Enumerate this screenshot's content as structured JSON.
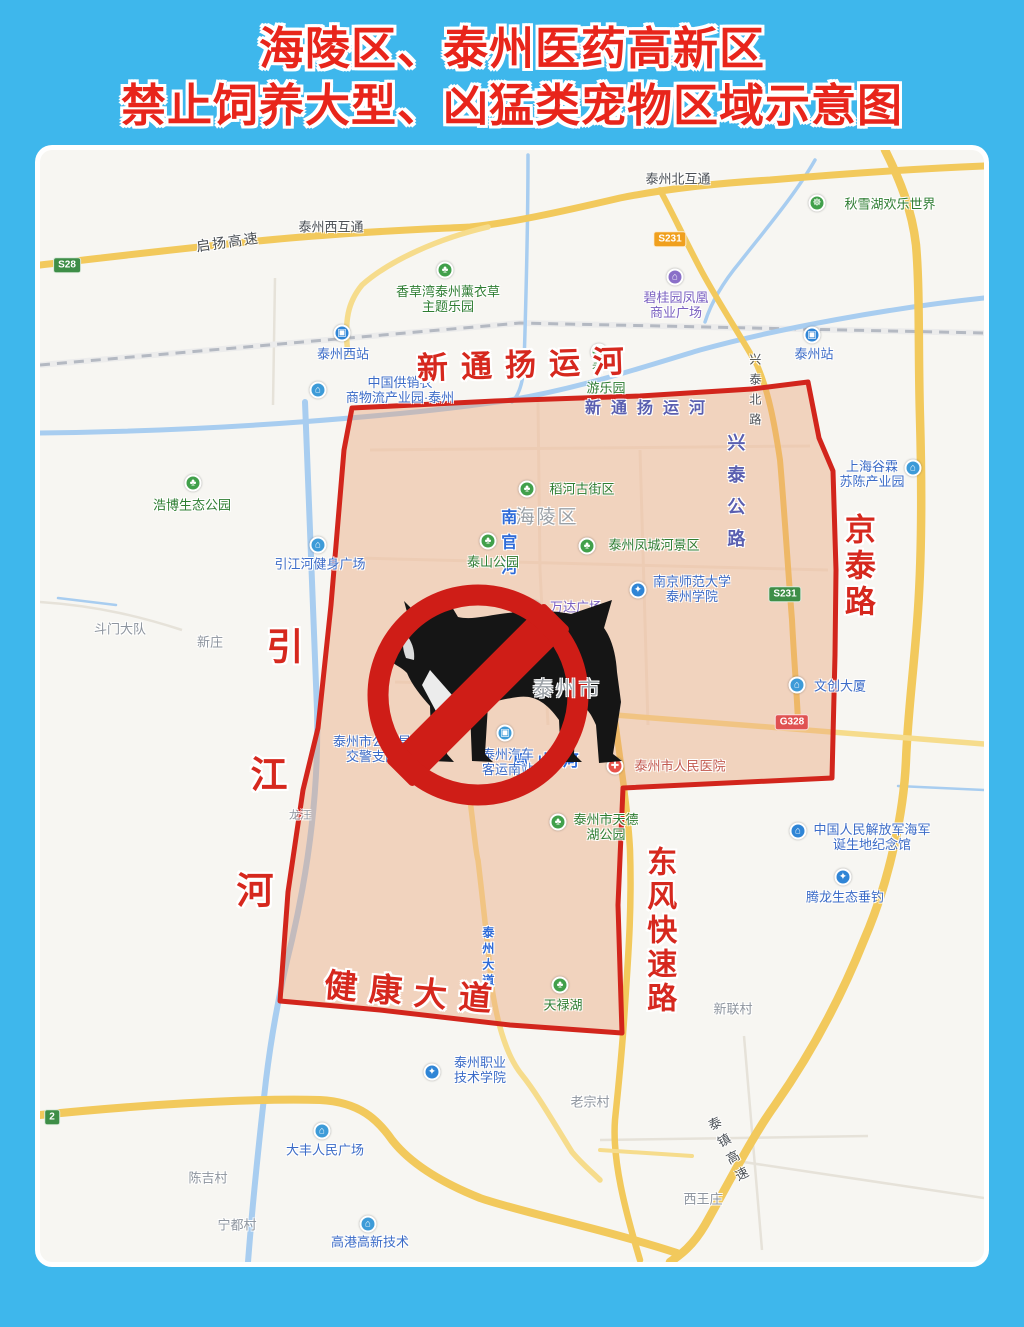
{
  "title": {
    "line1": "海陵区、泰州医药高新区",
    "line2": "禁止饲养大型、凶猛类宠物区域示意图"
  },
  "colors": {
    "frame_blue": "#3eb7ec",
    "title_red": "#e8251b",
    "zone_fill": "rgba(234,162,120,0.42)",
    "zone_border": "#d2251c",
    "sign_red": "#cf1d17",
    "road_yellow": "#f2c95c",
    "river_blue": "#a8cdf0",
    "railway_gray": "#b4b9c2"
  },
  "map": {
    "labels": [
      {
        "name": "canal-label-red",
        "kind": "red-road",
        "text": "新通扬运河",
        "x": 487,
        "y": 215,
        "size": 31,
        "spacing": 13,
        "rotate": -2
      },
      {
        "name": "jingtai-road-label",
        "kind": "red-road",
        "text": "京泰路",
        "x": 817,
        "y": 417,
        "size": 31,
        "spacing": 5,
        "vertical": true
      },
      {
        "name": "yinjiang-river-char-1",
        "kind": "red-road",
        "text": "引",
        "x": 245,
        "y": 498,
        "size": 37
      },
      {
        "name": "yinjiang-river-char-2",
        "kind": "red-road",
        "text": "江",
        "x": 229,
        "y": 626,
        "size": 37
      },
      {
        "name": "yinjiang-river-char-3",
        "kind": "red-road",
        "text": "河",
        "x": 215,
        "y": 742,
        "size": 37
      },
      {
        "name": "jiankang-avenue-label",
        "kind": "red-road",
        "text": "健康大道",
        "x": 374,
        "y": 843,
        "size": 33,
        "spacing": 12,
        "rotate": 5
      },
      {
        "name": "dongfeng-expressway-label",
        "kind": "red-road",
        "text": "东风快速路",
        "x": 618,
        "y": 781,
        "size": 30,
        "spacing": 4,
        "vertical": true
      },
      {
        "name": "canal-label-blue",
        "kind": "purple-road",
        "text": "新通扬运河",
        "x": 610,
        "y": 259,
        "size": 16,
        "spacing": 10
      },
      {
        "name": "xingtai-highway-label",
        "kind": "purple-road",
        "text": "兴泰公路",
        "x": 695,
        "y": 347,
        "size": 18,
        "spacing": 14,
        "vertical": true
      },
      {
        "name": "nanguan-river-label",
        "kind": "blue-road",
        "text": "南官河",
        "x": 466,
        "y": 396,
        "size": 16,
        "spacing": 9,
        "vertical": true
      },
      {
        "name": "zhoushan-river-label",
        "kind": "blue-road",
        "text": "周山河",
        "x": 510,
        "y": 612,
        "size": 16,
        "spacing": 9
      },
      {
        "name": "taizhou-avenue-label",
        "kind": "blue-road",
        "text": "泰州大道",
        "x": 447,
        "y": 808,
        "size": 12,
        "spacing": 4,
        "vertical": true
      },
      {
        "name": "qiyang-expressway-label",
        "kind": "dark-road",
        "text": "启扬高速",
        "x": 188,
        "y": 92,
        "size": 14,
        "rotate": -8,
        "spacing": 2
      },
      {
        "name": "taizhou-west-interchange-label",
        "kind": "dark-road",
        "text": "泰州西互通",
        "x": 291,
        "y": 78,
        "size": 13
      },
      {
        "name": "taizhou-north-interchange-label",
        "kind": "dark-road",
        "text": "泰州北互通",
        "x": 638,
        "y": 30,
        "size": 13
      },
      {
        "name": "xingtai-north-road-label",
        "kind": "dark-road",
        "text": "兴泰北路",
        "x": 714,
        "y": 243,
        "size": 12,
        "spacing": 8,
        "vertical": true
      },
      {
        "name": "taizhen-expressway-label",
        "kind": "dark-road",
        "text": "泰镇高速",
        "x": 688,
        "y": 1002,
        "size": 13,
        "spacing": 6,
        "vertical": true,
        "rotate": -28
      },
      {
        "name": "hailing-district-label",
        "kind": "area",
        "text": "海陵区",
        "x": 507,
        "y": 368,
        "size": 19
      },
      {
        "name": "taizhou-city-label",
        "kind": "area",
        "text": "泰州市",
        "x": 527,
        "y": 540,
        "size": 21,
        "layer": "top"
      },
      {
        "name": "doumen-dadui-label",
        "kind": "village",
        "text": "斗门大队",
        "x": 80,
        "y": 480
      },
      {
        "name": "xinzhuang-label",
        "kind": "village",
        "text": "新庄",
        "x": 170,
        "y": 493
      },
      {
        "name": "longwang-label",
        "kind": "village",
        "text": "龙汪",
        "x": 260,
        "y": 666,
        "size": 11
      },
      {
        "name": "xinlian-village-label",
        "kind": "village",
        "text": "新联村",
        "x": 693,
        "y": 860
      },
      {
        "name": "laozong-village-label",
        "kind": "village",
        "text": "老宗村",
        "x": 550,
        "y": 953
      },
      {
        "name": "xiwangzhuang-label",
        "kind": "village",
        "text": "西王庄",
        "x": 663,
        "y": 1050
      },
      {
        "name": "chenji-village-label",
        "kind": "village",
        "text": "陈吉村",
        "x": 168,
        "y": 1029
      },
      {
        "name": "ningdu-village-label",
        "kind": "village",
        "text": "宁都村",
        "x": 197,
        "y": 1076
      },
      {
        "name": "taizhou-west-station-icon",
        "kind": "icon",
        "icon": "station",
        "x": 302,
        "y": 183
      },
      {
        "name": "supply-logistics-park-icon",
        "kind": "icon",
        "icon": "building",
        "x": 278,
        "y": 240
      },
      {
        "name": "taizhou-station-icon",
        "kind": "icon",
        "icon": "station",
        "x": 772,
        "y": 185
      },
      {
        "name": "biguiyuan-icon",
        "kind": "icon",
        "icon": "mall",
        "x": 635,
        "y": 127
      },
      {
        "name": "qiuxue-lake-icon",
        "kind": "icon",
        "icon": "amusement",
        "x": 777,
        "y": 53
      },
      {
        "name": "lavender-park-icon",
        "kind": "icon",
        "icon": "park",
        "x": 405,
        "y": 120
      },
      {
        "name": "amusement-park-icon",
        "kind": "icon",
        "icon": "park",
        "x": 559,
        "y": 202
      },
      {
        "name": "daohe-street-icon",
        "kind": "icon",
        "icon": "park",
        "x": 487,
        "y": 339
      },
      {
        "name": "taishan-park-icon",
        "kind": "icon",
        "icon": "park",
        "x": 448,
        "y": 391
      },
      {
        "name": "fengcheng-river-icon",
        "kind": "icon",
        "icon": "park",
        "x": 547,
        "y": 396
      },
      {
        "name": "wanda-plaza-icon",
        "kind": "icon",
        "icon": "mall",
        "x": 493,
        "y": 459
      },
      {
        "name": "nanjing-normal-univ-icon",
        "kind": "icon",
        "icon": "school",
        "x": 598,
        "y": 440
      },
      {
        "name": "shanghai-gulin-icon",
        "kind": "icon",
        "icon": "building",
        "x": 873,
        "y": 318
      },
      {
        "name": "wenchuang-tower-icon",
        "kind": "icon",
        "icon": "building",
        "x": 757,
        "y": 535
      },
      {
        "name": "traffic-police-icon",
        "kind": "icon",
        "icon": "police",
        "x": 340,
        "y": 569
      },
      {
        "name": "bus-station-icon",
        "kind": "icon",
        "icon": "bus",
        "x": 465,
        "y": 583
      },
      {
        "name": "peoples-hospital-icon",
        "kind": "icon",
        "icon": "hospital",
        "x": 575,
        "y": 616
      },
      {
        "name": "tiande-lake-icon",
        "kind": "icon",
        "icon": "park",
        "x": 518,
        "y": 672
      },
      {
        "name": "tianlu-lake-icon",
        "kind": "icon",
        "icon": "park",
        "x": 520,
        "y": 835
      },
      {
        "name": "vocational-college-icon",
        "kind": "icon",
        "icon": "school",
        "x": 392,
        "y": 922
      },
      {
        "name": "dafeng-plaza-icon",
        "kind": "icon",
        "icon": "building",
        "x": 282,
        "y": 981
      },
      {
        "name": "gaogang-hightech-icon",
        "kind": "icon",
        "icon": "building",
        "x": 328,
        "y": 1074
      },
      {
        "name": "navy-memorial-icon",
        "kind": "icon",
        "icon": "museum",
        "x": 758,
        "y": 681
      },
      {
        "name": "tenglong-fishing-icon",
        "kind": "icon",
        "icon": "fishing",
        "x": 803,
        "y": 727
      },
      {
        "name": "fitness-plaza-icon",
        "kind": "icon",
        "icon": "building",
        "x": 278,
        "y": 395
      },
      {
        "name": "haobo-park-icon",
        "kind": "icon",
        "icon": "park",
        "x": 153,
        "y": 333
      },
      {
        "name": "taizhou-west-station-label",
        "kind": "poi-blue",
        "text": "泰州西站",
        "x": 303,
        "y": 205
      },
      {
        "name": "supply-logistics-park-label",
        "kind": "poi-blue",
        "lines": [
          "中国供销农",
          "商物流产业园·泰州"
        ],
        "x": 360,
        "y": 241
      },
      {
        "name": "taizhou-station-label",
        "kind": "poi-blue",
        "text": "泰州站",
        "x": 774,
        "y": 205
      },
      {
        "name": "biguiyuan-label",
        "kind": "poi-purple",
        "lines": [
          "碧桂园凤凰",
          "商业广场"
        ],
        "x": 636,
        "y": 156
      },
      {
        "name": "qiuxue-lake-label",
        "kind": "poi-green",
        "text": "秋雪湖欢乐世界",
        "x": 850,
        "y": 55
      },
      {
        "name": "lavender-park-label",
        "kind": "poi-green",
        "lines": [
          "香草湾泰州薰衣草",
          "主题乐园"
        ],
        "x": 408,
        "y": 150
      },
      {
        "name": "amusement-park-label-xiang",
        "kind": "poi-green",
        "text": "香",
        "x": 558,
        "y": 219,
        "size": 12
      },
      {
        "name": "amusement-park-label",
        "kind": "poi-green",
        "text": "游乐园",
        "x": 566,
        "y": 239
      },
      {
        "name": "daohe-street-label",
        "kind": "poi-green",
        "text": "稻河古街区",
        "x": 542,
        "y": 340
      },
      {
        "name": "taishan-park-label",
        "kind": "poi-green",
        "text": "泰山公园",
        "x": 453,
        "y": 413
      },
      {
        "name": "fengcheng-river-label",
        "kind": "poi-green",
        "text": "泰州凤城河景区",
        "x": 614,
        "y": 396
      },
      {
        "name": "wanda-plaza-label",
        "kind": "poi-purple",
        "text": "万达广场",
        "x": 536,
        "y": 458
      },
      {
        "name": "nanjing-normal-univ-label",
        "kind": "poi-blue",
        "lines": [
          "南京师范大学",
          "泰州学院"
        ],
        "x": 652,
        "y": 440
      },
      {
        "name": "shanghai-gulin-label",
        "kind": "poi-blue",
        "lines": [
          "上海谷霖",
          "苏陈产业园"
        ],
        "x": 832,
        "y": 325
      },
      {
        "name": "wenchuang-tower-label",
        "kind": "poi-blue",
        "text": "文创大厦",
        "x": 800,
        "y": 537
      },
      {
        "name": "traffic-police-label",
        "kind": "poi-blue",
        "lines": [
          "泰州市公安局",
          "交警支队"
        ],
        "x": 332,
        "y": 600
      },
      {
        "name": "bus-station-label",
        "kind": "poi-blue",
        "lines": [
          "泰州汽车",
          "客运南站"
        ],
        "x": 468,
        "y": 613
      },
      {
        "name": "peoples-hospital-label",
        "kind": "poi-red",
        "text": "泰州市人民医院",
        "x": 640,
        "y": 617
      },
      {
        "name": "tiande-lake-label",
        "kind": "poi-green",
        "lines": [
          "泰州市天德",
          "湖公园"
        ],
        "x": 566,
        "y": 678
      },
      {
        "name": "tianlu-lake-label",
        "kind": "poi-green",
        "text": "天禄湖",
        "x": 523,
        "y": 856
      },
      {
        "name": "vocational-college-label",
        "kind": "poi-blue",
        "lines": [
          "泰州职业",
          "技术学院"
        ],
        "x": 440,
        "y": 921
      },
      {
        "name": "dafeng-plaza-label",
        "kind": "poi-blue",
        "text": "大丰人民广场",
        "x": 285,
        "y": 1001
      },
      {
        "name": "gaogang-hightech-label",
        "kind": "poi-blue",
        "text": "高港高新技术",
        "x": 330,
        "y": 1093
      },
      {
        "name": "navy-memorial-label",
        "kind": "poi-blue",
        "lines": [
          "中国人民解放军海军",
          "诞生地纪念馆"
        ],
        "x": 832,
        "y": 688
      },
      {
        "name": "tenglong-fishing-label",
        "kind": "poi-blue",
        "text": "腾龙生态垂钓",
        "x": 805,
        "y": 748
      },
      {
        "name": "fitness-plaza-label",
        "kind": "poi-blue",
        "text": "引江河健身广场",
        "x": 280,
        "y": 415
      },
      {
        "name": "haobo-park-label",
        "kind": "poi-green",
        "text": "浩博生态公园",
        "x": 152,
        "y": 356
      },
      {
        "name": "badge-s28",
        "kind": "badge-green",
        "text": "S28",
        "x": 27,
        "y": 115
      },
      {
        "name": "badge-s231-north",
        "kind": "badge-yellow",
        "text": "S231",
        "x": 630,
        "y": 89
      },
      {
        "name": "badge-s231-south",
        "kind": "badge-green",
        "text": "S231",
        "x": 745,
        "y": 444
      },
      {
        "name": "badge-g328",
        "kind": "badge-red",
        "text": "G328",
        "x": 752,
        "y": 572
      },
      {
        "name": "badge-s2-partial",
        "kind": "badge-green",
        "text": "2",
        "x": 12,
        "y": 967
      }
    ]
  }
}
